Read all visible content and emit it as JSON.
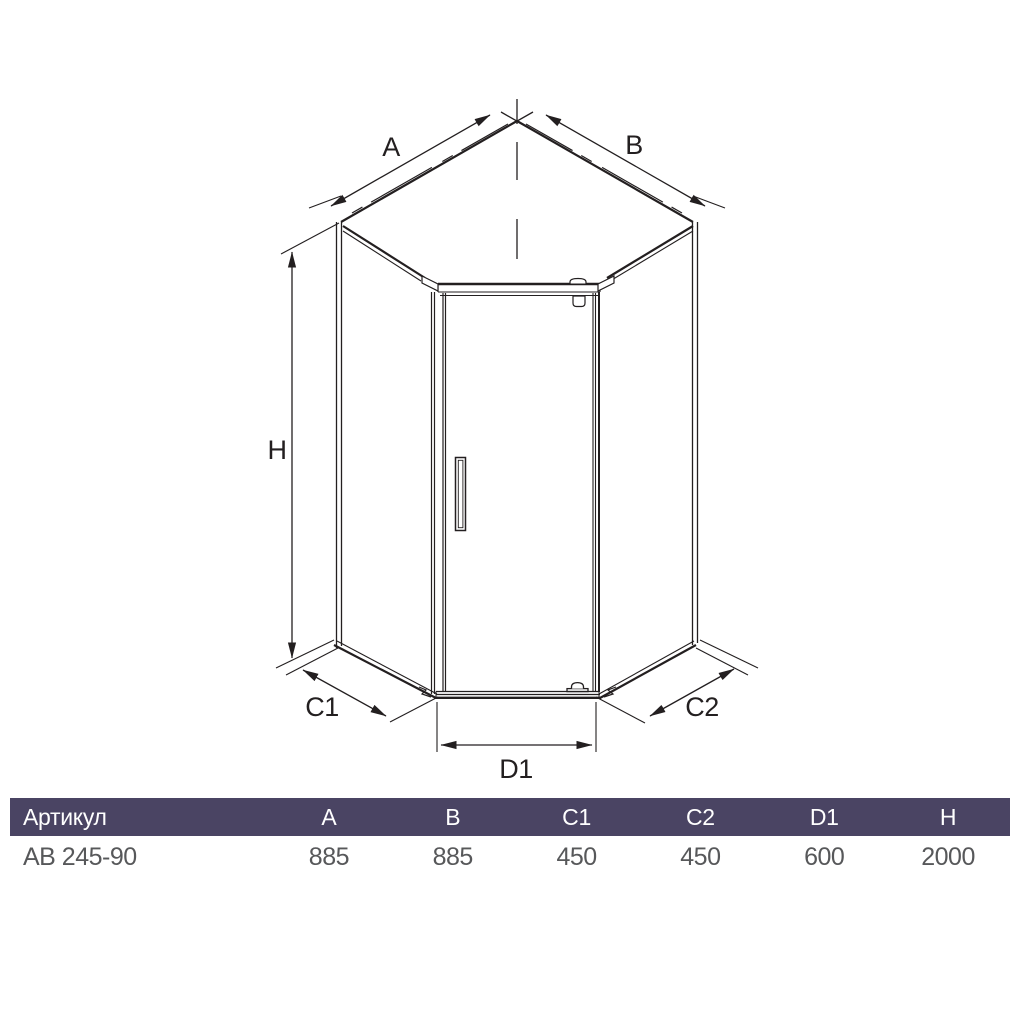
{
  "diagram": {
    "dimension_labels": {
      "a": "A",
      "b": "B",
      "h": "H",
      "c1": "C1",
      "c2": "C2",
      "d1": "D1"
    },
    "line_color": "#231f20"
  },
  "table": {
    "header_bg": "#4a4463",
    "header_text_color": "#ffffff",
    "row_text_color": "#57585a",
    "columns": [
      {
        "label": "Артикул"
      },
      {
        "label": "A"
      },
      {
        "label": "B"
      },
      {
        "label": "C1"
      },
      {
        "label": "C2"
      },
      {
        "label": "D1"
      },
      {
        "label": "H"
      }
    ],
    "rows": [
      {
        "article": "AB 245-90",
        "a": "885",
        "b": "885",
        "c1": "450",
        "c2": "450",
        "d1": "600",
        "h": "2000"
      }
    ]
  }
}
